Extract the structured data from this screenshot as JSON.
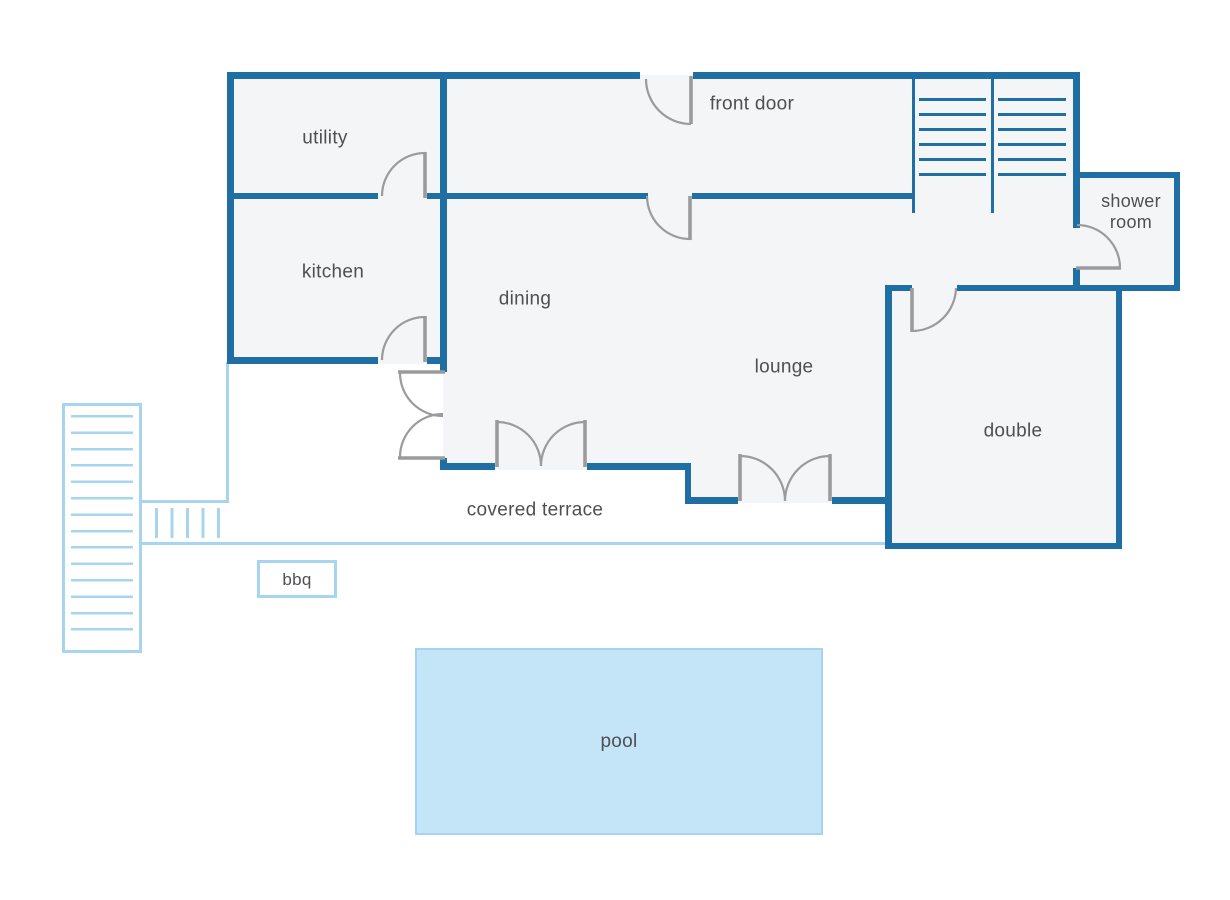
{
  "diagram": {
    "type": "floor-plan",
    "rooms": {
      "utility": "utility",
      "kitchen": "kitchen",
      "dining": "dining",
      "lounge": "lounge",
      "double": "double",
      "shower_room": "shower room",
      "front_door": "front door",
      "covered_terrace": "covered terrace",
      "bbq": "bbq",
      "pool": "pool"
    },
    "colors": {
      "wall": "#1f6fa5",
      "room_fill": "#f4f5f6",
      "door": "#9b9b9d",
      "outdoor_light": "#a7d4ef",
      "pool_fill": "#c3e5f7",
      "pool_border": "#a6d4ee",
      "label_text": "#4d4f52",
      "background": "#ffffff"
    }
  }
}
